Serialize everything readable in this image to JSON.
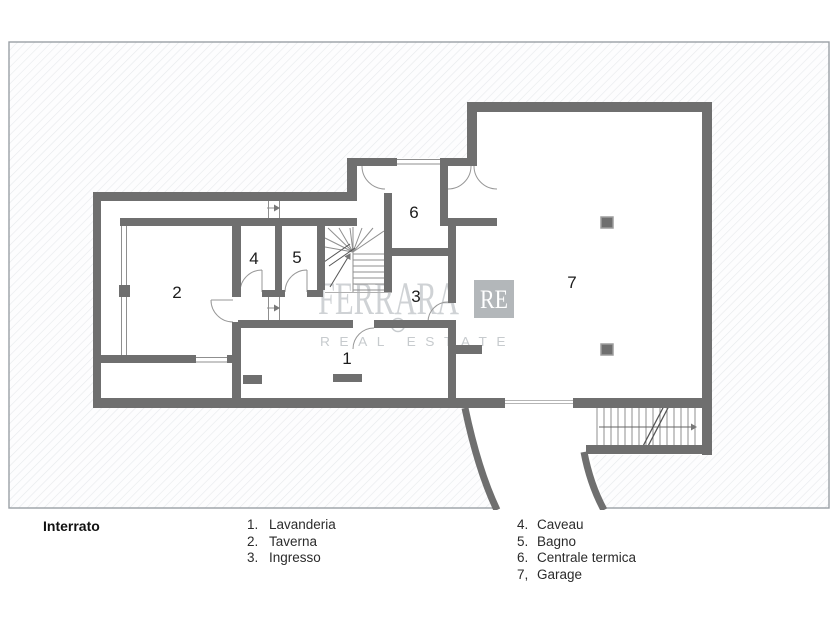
{
  "plan": {
    "rooms": [
      {
        "number": "1",
        "name": "Lavanderia"
      },
      {
        "number": "2",
        "name": "Taverna"
      },
      {
        "number": "3",
        "name": "Ingresso"
      },
      {
        "number": "4",
        "name": "Caveau"
      },
      {
        "number": "5",
        "name": "Bagno"
      },
      {
        "number": "6",
        "name": "Centrale termica"
      },
      {
        "number": "7",
        "name": "Garage"
      }
    ]
  },
  "watermark": {
    "name": "FERRARA",
    "badge": "RE",
    "tagline": "REAL ESTATE"
  },
  "legend": {
    "title": "Interrato",
    "column1": [
      {
        "num": "1.",
        "label": "Lavanderia"
      },
      {
        "num": "2.",
        "label": "Taverna"
      },
      {
        "num": "3.",
        "label": "Ingresso"
      }
    ],
    "column2": [
      {
        "num": "4.",
        "label": "Caveau"
      },
      {
        "num": "5.",
        "label": "Bagno"
      },
      {
        "num": "6.",
        "label": "Centrale termica"
      },
      {
        "num": "7,",
        "label": "Garage"
      }
    ]
  },
  "colors": {
    "wall": "#6f6f6f",
    "frame_border": "#9aa0a5",
    "watermark": "#c7cbce",
    "badge_bg": "#b3b7ba"
  }
}
